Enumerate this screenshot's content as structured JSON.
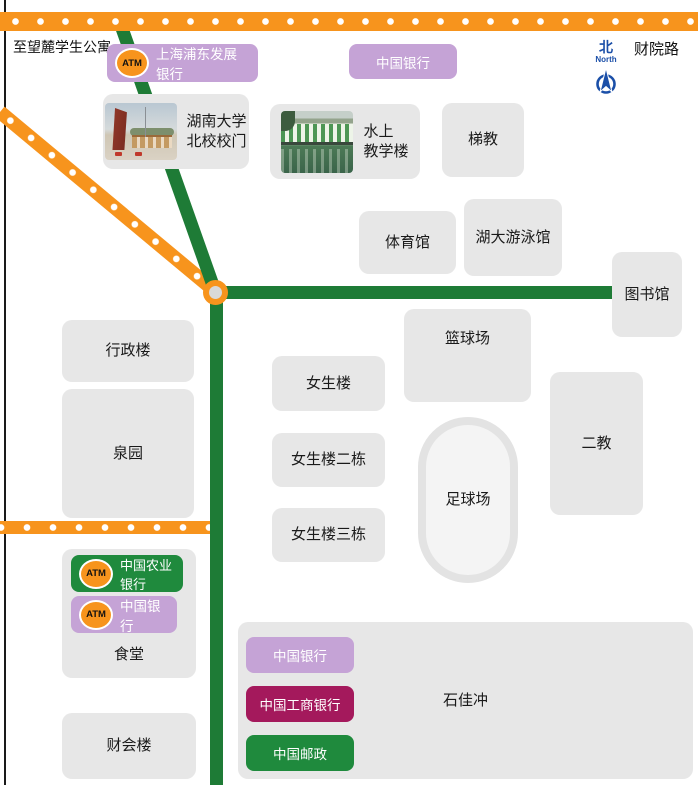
{
  "colors": {
    "road_orange": "#F7941D",
    "road_green": "#1E7B36",
    "bank_purple": "#C5A3D6",
    "bank_magenta": "#A4195C",
    "bank_green": "#1F8A3D",
    "building_gray": "#E7E7E7",
    "compass_blue": "#1B4FA8"
  },
  "labels": {
    "to_wanglu_apartments": "至望麓学生公寓",
    "caiyuan_road": "财院路",
    "compass_zh": "北",
    "compass_en": "North",
    "atm_badge": "ATM"
  },
  "pois": {
    "spdb_bank": {
      "label": "上海浦东发展银行"
    },
    "boc_north": {
      "label": "中国银行"
    },
    "gate": {
      "line1": "湖南大学",
      "line2": "北校校门"
    },
    "water_teaching": {
      "line1": "水上",
      "line2": "教学楼"
    },
    "lecture_hall": {
      "label": "梯教"
    },
    "gymnasium": {
      "label": "体育馆"
    },
    "swimming_pool": {
      "label": "湖大游泳馆"
    },
    "library": {
      "label": "图书馆"
    },
    "admin_building": {
      "label": "行政楼"
    },
    "quanyuan": {
      "label": "泉园"
    },
    "girls_dorm_1": {
      "label": "女生楼"
    },
    "girls_dorm_2": {
      "label": "女生楼二栋"
    },
    "girls_dorm_3": {
      "label": "女生楼三栋"
    },
    "basketball_court": {
      "label": "篮球场"
    },
    "football_field": {
      "label": "足球场"
    },
    "second_teaching": {
      "label": "二教"
    },
    "canteen": {
      "label": "食堂"
    },
    "abc_bank": {
      "label": "中国农业银行"
    },
    "boc_canteen": {
      "label": "中国银行"
    },
    "finance_building": {
      "label": "财会楼"
    },
    "shijiachong": {
      "label": "石佳冲"
    },
    "boc_shijiachong": {
      "label": "中国银行"
    },
    "icbc_bank": {
      "label": "中国工商银行"
    },
    "china_post": {
      "label": "中国邮政"
    }
  }
}
